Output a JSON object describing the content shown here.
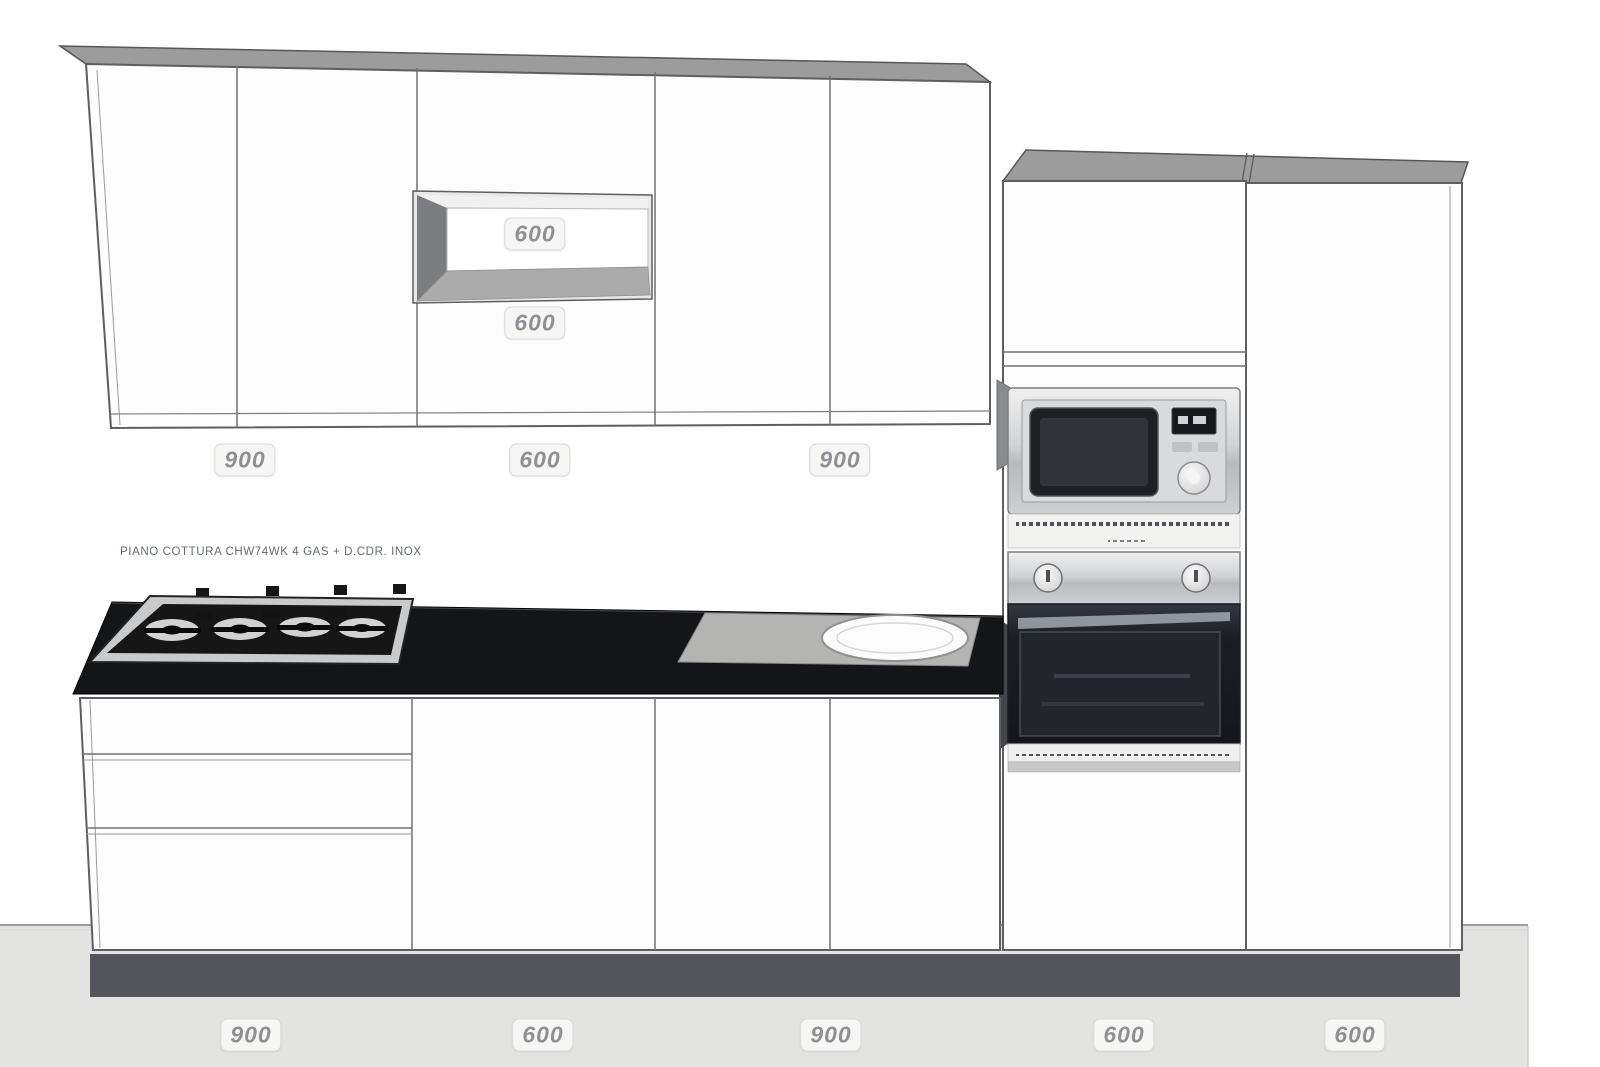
{
  "scene": {
    "description": "Kitchen elevation render with dimension annotations",
    "colors": {
      "wall": "#ffffff",
      "floor": "#e3e3e1",
      "skirting_line": "#9c9c9c",
      "plinth": "#53545c",
      "cabinet_front": "#fdfdfd",
      "cabinet_top": "#9c9c9c",
      "outline": "#5d5f62",
      "countertop": "#141518",
      "niche_shadow": "#7b7d80",
      "steel": "#c9cacc",
      "sink_drainer": "#b4b4b3",
      "oven_glass": "#1b1d23"
    }
  },
  "labels": {
    "hob_product": "PIANO COTTURA CHW74WK 4 GAS + D.CDR. INOX"
  },
  "dimensions": {
    "wall_left": "900",
    "wall_mid": "600",
    "wall_right": "900",
    "niche_width": "600",
    "niche_below": "600",
    "base_left": "900",
    "base_mid": "600",
    "base_right": "900",
    "tall_appliance": "600",
    "tall_pantry": "600"
  }
}
